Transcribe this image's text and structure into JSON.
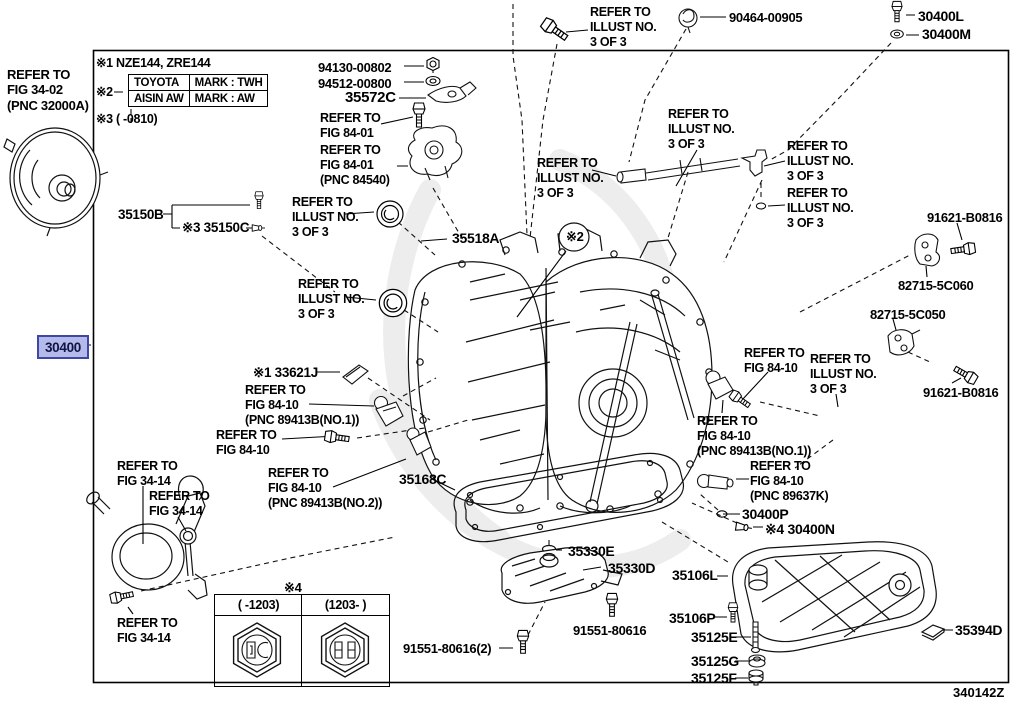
{
  "doc": {
    "diagram_id": "340142Z"
  },
  "highlight": {
    "part_number": "30400",
    "bg": "#b4bae9",
    "border": "#3f47a5",
    "text_color": "#101345"
  },
  "notes": {
    "note1": "※1 NZE144, ZRE144",
    "note2_marker": "※2",
    "note3": "※3 (   -0810)",
    "mark_table": {
      "rows": [
        {
          "maker": "TOYOTA",
          "mark": "MARK : TWH"
        },
        {
          "maker": "AISIN AW",
          "mark": "MARK : AW"
        }
      ]
    }
  },
  "hex_table": {
    "marker": "※4",
    "columns": [
      "(  -1203)",
      "(1203-  )"
    ]
  },
  "labels": [
    {
      "name": "refer-fig-34-02",
      "text": "REFER TO\nFIG 34-02\n(PNC 32000A)",
      "x": 7,
      "y": 67,
      "size": 13,
      "interactable": false
    },
    {
      "name": "part-35150B",
      "text": "35150B",
      "x": 118,
      "y": 207,
      "size": 13.5,
      "interactable": true
    },
    {
      "name": "part-35150C",
      "text": "※3 35150C",
      "x": 182,
      "y": 220,
      "size": 13.5,
      "interactable": true
    },
    {
      "name": "refer-illust-seal-upper",
      "text": "REFER TO\nILLUST NO.\n3 OF 3",
      "x": 292,
      "y": 195,
      "interactable": false
    },
    {
      "name": "part-35518A",
      "text": "35518A",
      "x": 452,
      "y": 230,
      "size": 14,
      "interactable": true
    },
    {
      "name": "refer-illust-seal-lower",
      "text": "REFER TO\nILLUST NO.\n3 OF 3",
      "x": 298,
      "y": 277,
      "interactable": false
    },
    {
      "name": "part-94130-00802",
      "text": "94130-00802",
      "x": 318,
      "y": 60,
      "size": 13,
      "interactable": true
    },
    {
      "name": "part-94512-00800",
      "text": "94512-00800",
      "x": 318,
      "y": 76,
      "size": 13,
      "interactable": true
    },
    {
      "name": "part-35572C",
      "text": "35572C",
      "x": 345,
      "y": 89,
      "size": 15,
      "interactable": true
    },
    {
      "name": "refer-fig-84-01-a",
      "text": "REFER TO\nFIG 84-01",
      "x": 320,
      "y": 111,
      "interactable": false
    },
    {
      "name": "refer-fig-84-01-b",
      "text": "REFER TO\nFIG 84-01\n(PNC 84540)",
      "x": 320,
      "y": 143,
      "interactable": false
    },
    {
      "name": "refer-illust-top",
      "text": "REFER TO\nILLUST NO.\n3 OF 3",
      "x": 590,
      "y": 5,
      "interactable": false
    },
    {
      "name": "part-90464-00905",
      "text": "90464-00905",
      "x": 729,
      "y": 10,
      "size": 13,
      "interactable": true
    },
    {
      "name": "part-30400L",
      "text": "30400L",
      "x": 918,
      "y": 8,
      "size": 14,
      "interactable": true
    },
    {
      "name": "part-30400M",
      "text": "30400M",
      "x": 922,
      "y": 26,
      "size": 14,
      "interactable": true
    },
    {
      "name": "refer-illust-tube-center",
      "text": "REFER TO\nILLUST NO.\n3 OF 3",
      "x": 668,
      "y": 107,
      "interactable": false
    },
    {
      "name": "refer-illust-tube-left",
      "text": "REFER TO\nILLUST NO.\n3 OF 3",
      "x": 537,
      "y": 156,
      "interactable": false
    },
    {
      "name": "refer-illust-tube-right",
      "text": "REFER TO\nILLUST NO.\n3 OF 3",
      "x": 787,
      "y": 139,
      "interactable": false
    },
    {
      "name": "refer-illust-oring",
      "text": "REFER TO\nILLUST NO.\n3 OF 3",
      "x": 787,
      "y": 186,
      "interactable": false
    },
    {
      "name": "part-91621-B0816-a",
      "text": "91621-B0816",
      "x": 927,
      "y": 210,
      "size": 13,
      "interactable": true
    },
    {
      "name": "part-82715-5C060",
      "text": "82715-5C060",
      "x": 898,
      "y": 278,
      "size": 13,
      "interactable": true
    },
    {
      "name": "part-82715-5C050",
      "text": "82715-5C050",
      "x": 870,
      "y": 307,
      "size": 13,
      "interactable": true
    },
    {
      "name": "part-91621-B0816-b",
      "text": "91621-B0816",
      "x": 923,
      "y": 385,
      "size": 13,
      "interactable": true
    },
    {
      "name": "part-33621J",
      "text": "※1 33621J",
      "x": 253,
      "y": 365,
      "size": 13.5,
      "interactable": true
    },
    {
      "name": "refer-fig-84-10-no1-left",
      "text": "REFER TO\nFIG 84-10\n(PNC 89413B(NO.1))",
      "x": 245,
      "y": 383,
      "interactable": false
    },
    {
      "name": "refer-fig-84-10-bolt",
      "text": "REFER TO\nFIG 84-10",
      "x": 216,
      "y": 428,
      "interactable": false
    },
    {
      "name": "refer-fig-84-10-right",
      "text": "REFER TO\nFIG 84-10",
      "x": 744,
      "y": 346,
      "interactable": false
    },
    {
      "name": "refer-illust-seal-right",
      "text": "REFER TO\nILLUST NO.\n3 OF 3",
      "x": 810,
      "y": 352,
      "interactable": false
    },
    {
      "name": "refer-fig-84-10-no1-right",
      "text": "REFER TO\nFIG 84-10\n(PNC 89413B(NO.1))",
      "x": 697,
      "y": 414,
      "interactable": false
    },
    {
      "name": "refer-fig-84-10-89637K",
      "text": "REFER TO\nFIG 84-10\n(PNC 89637K)",
      "x": 750,
      "y": 459,
      "interactable": false
    },
    {
      "name": "part-30400P",
      "text": "30400P",
      "x": 742,
      "y": 506,
      "size": 14,
      "interactable": true
    },
    {
      "name": "part-30400N",
      "text": "※4 30400N",
      "x": 765,
      "y": 521,
      "size": 14,
      "interactable": true
    },
    {
      "name": "refer-fig-34-14-a",
      "text": "REFER TO\nFIG 34-14",
      "x": 117,
      "y": 459,
      "interactable": false
    },
    {
      "name": "refer-fig-34-14-b",
      "text": "REFER TO\nFIG 34-14",
      "x": 149,
      "y": 489,
      "interactable": false
    },
    {
      "name": "refer-fig-34-14-c",
      "text": "REFER TO\nFIG 34-14",
      "x": 117,
      "y": 616,
      "interactable": false
    },
    {
      "name": "refer-fig-84-10-no2",
      "text": "REFER TO\nFIG 84-10\n(PNC 89413B(NO.2))",
      "x": 268,
      "y": 466,
      "interactable": false
    },
    {
      "name": "part-35168C",
      "text": "35168C",
      "x": 399,
      "y": 471,
      "size": 14,
      "interactable": true
    },
    {
      "name": "part-35330E",
      "text": "35330E",
      "x": 568,
      "y": 543,
      "size": 14,
      "interactable": true
    },
    {
      "name": "part-35330D",
      "text": "35330D",
      "x": 608,
      "y": 560,
      "size": 14,
      "interactable": true
    },
    {
      "name": "part-91551-80616",
      "text": "91551-80616",
      "x": 573,
      "y": 623,
      "size": 13,
      "interactable": true
    },
    {
      "name": "part-91551-80616-2",
      "text": "91551-80616(2)",
      "x": 403,
      "y": 641,
      "size": 13,
      "interactable": true
    },
    {
      "name": "part-35106L",
      "text": "35106L",
      "x": 672,
      "y": 567,
      "size": 14,
      "interactable": true
    },
    {
      "name": "part-35106P",
      "text": "35106P",
      "x": 669,
      "y": 610,
      "size": 14,
      "interactable": true
    },
    {
      "name": "part-35125E",
      "text": "35125E",
      "x": 691,
      "y": 629,
      "size": 14,
      "interactable": true
    },
    {
      "name": "part-35125G",
      "text": "35125G",
      "x": 691,
      "y": 653,
      "size": 14,
      "interactable": true
    },
    {
      "name": "part-35125F",
      "text": "35125F",
      "x": 691,
      "y": 670,
      "size": 14,
      "interactable": true
    },
    {
      "name": "part-35394D",
      "text": "35394D",
      "x": 955,
      "y": 622,
      "size": 14,
      "interactable": true
    },
    {
      "name": "note-hex-marker",
      "text": "※4",
      "x": 284,
      "y": 580,
      "size": 13,
      "interactable": false
    },
    {
      "name": "balloon-note",
      "text": "※2",
      "x": 566,
      "y": 229,
      "size": 13,
      "interactable": false
    }
  ]
}
